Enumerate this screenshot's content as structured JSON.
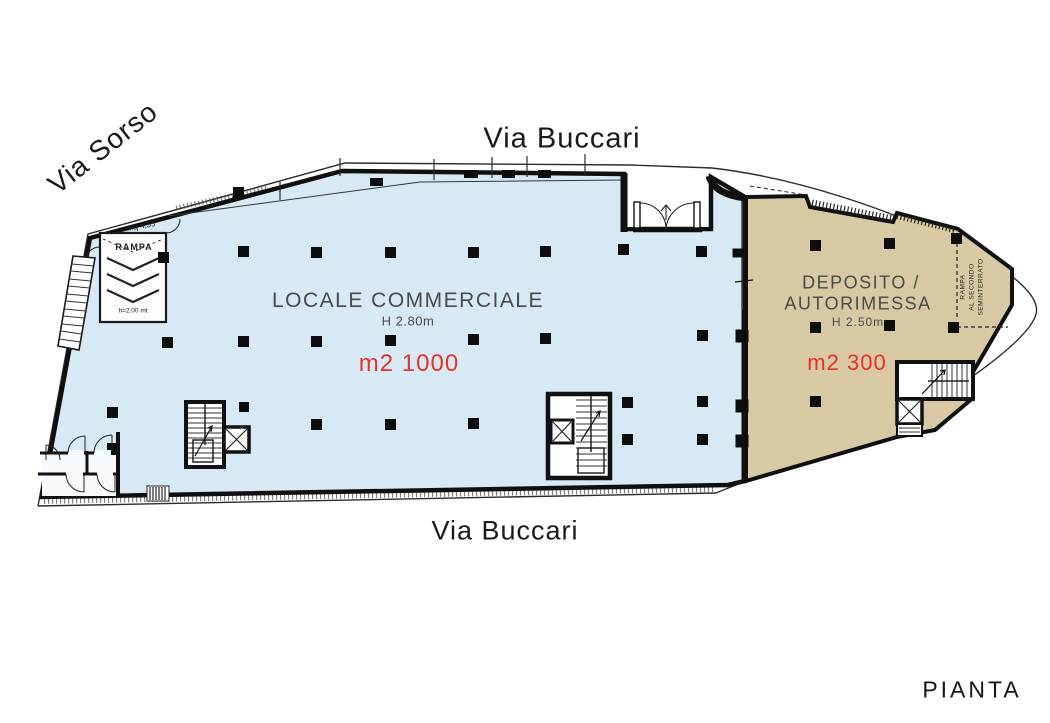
{
  "plan": {
    "title": "PIANTA",
    "streets": {
      "top": "Via Buccari",
      "bottom": "Via Buccari",
      "left": "Via Sorso"
    },
    "commercial": {
      "title": "LOCALE COMMERCIALE",
      "height": "H 2.80m",
      "area": "m2 1000",
      "fill": "#d7e9f5"
    },
    "deposit": {
      "title_line1": "DEPOSITO /",
      "title_line2": "AUTORIMESSA",
      "height": "H 2.50m",
      "area": "m2 300",
      "fill": "#d9c8a4"
    },
    "ramp_room": {
      "label": "RAMPA",
      "area": "mq 4,55",
      "clearance": "h=2.00 mt"
    },
    "ramp_note": {
      "line1": "RAMPA",
      "line2": "AL SECONDO",
      "line3": "SEMINTERRATO"
    },
    "colors": {
      "accent_red": "#e6332a",
      "wall_black": "#101010",
      "outline_gray": "#2b2b2b",
      "label_gray": "#4a4a4a"
    }
  }
}
